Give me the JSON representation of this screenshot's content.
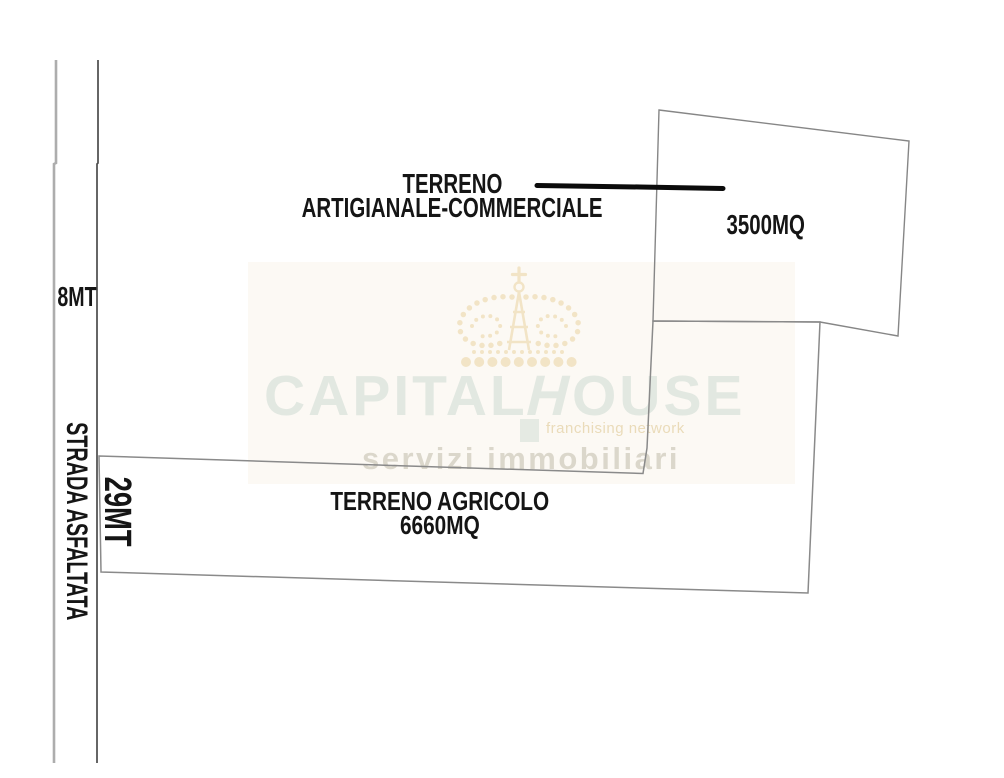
{
  "diagram": {
    "road": {
      "name_label": "STRADA ASFALTATA",
      "width_label": "8MT",
      "frontage_label": "29MT"
    },
    "parcels": {
      "commercial": {
        "title_line1": "TERRENO",
        "title_line2": "ARTIGIANALE-COMMERCIALE",
        "area_label": "3500MQ"
      },
      "agricultural": {
        "title": "TERRENO AGRICOLO",
        "area_label": "6660MQ"
      }
    },
    "colors": {
      "boundary_gray": "#8a8a8a",
      "road_left_line": "#adadad",
      "road_right_line": "#4c4c4c",
      "indicator_black": "#0b0b0b",
      "label_text": "#151515"
    }
  },
  "watermark": {
    "brand_left": "CAPITAL",
    "brand_h": "H",
    "brand_right": "OUSE",
    "tagline": "franchising network",
    "subtitle": "servizi immobiliari",
    "crown_icon": "crown-icon",
    "colors": {
      "brand_text": "#e2e8e1",
      "tagline_text": "#eadbb9",
      "subtitle_text": "#dbd7cb",
      "crown": "#f2e4c6"
    }
  }
}
